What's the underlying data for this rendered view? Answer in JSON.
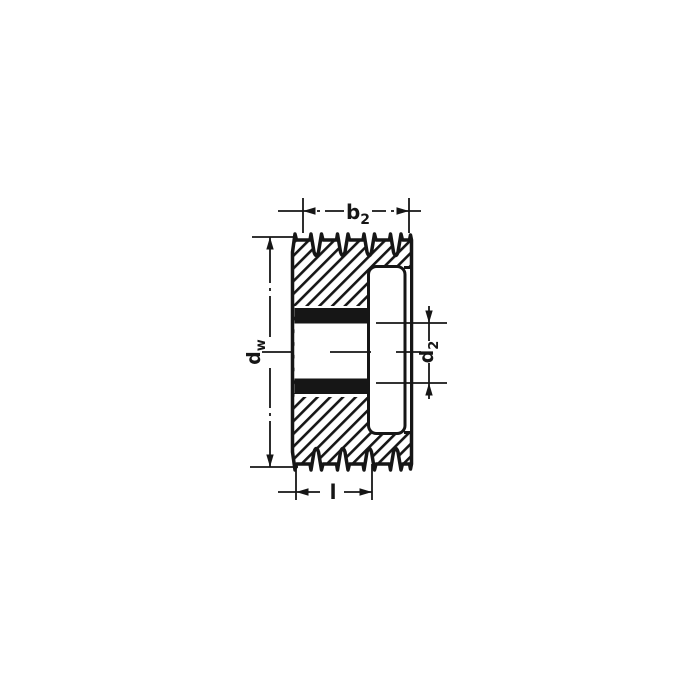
{
  "figure": {
    "kind": "technical-drawing",
    "subject": "v-belt-pulley-cross-section",
    "background_color": "#ffffff",
    "ink_color": "#161616",
    "groove_count": 4,
    "rim_peak_count": 5,
    "labels": {
      "b2": {
        "base": "b",
        "sub": "2"
      },
      "dw": {
        "base": "d",
        "sub": "w"
      },
      "d2": {
        "base": "d",
        "sub": "2"
      },
      "l": {
        "base": "l",
        "sub": ""
      }
    }
  }
}
